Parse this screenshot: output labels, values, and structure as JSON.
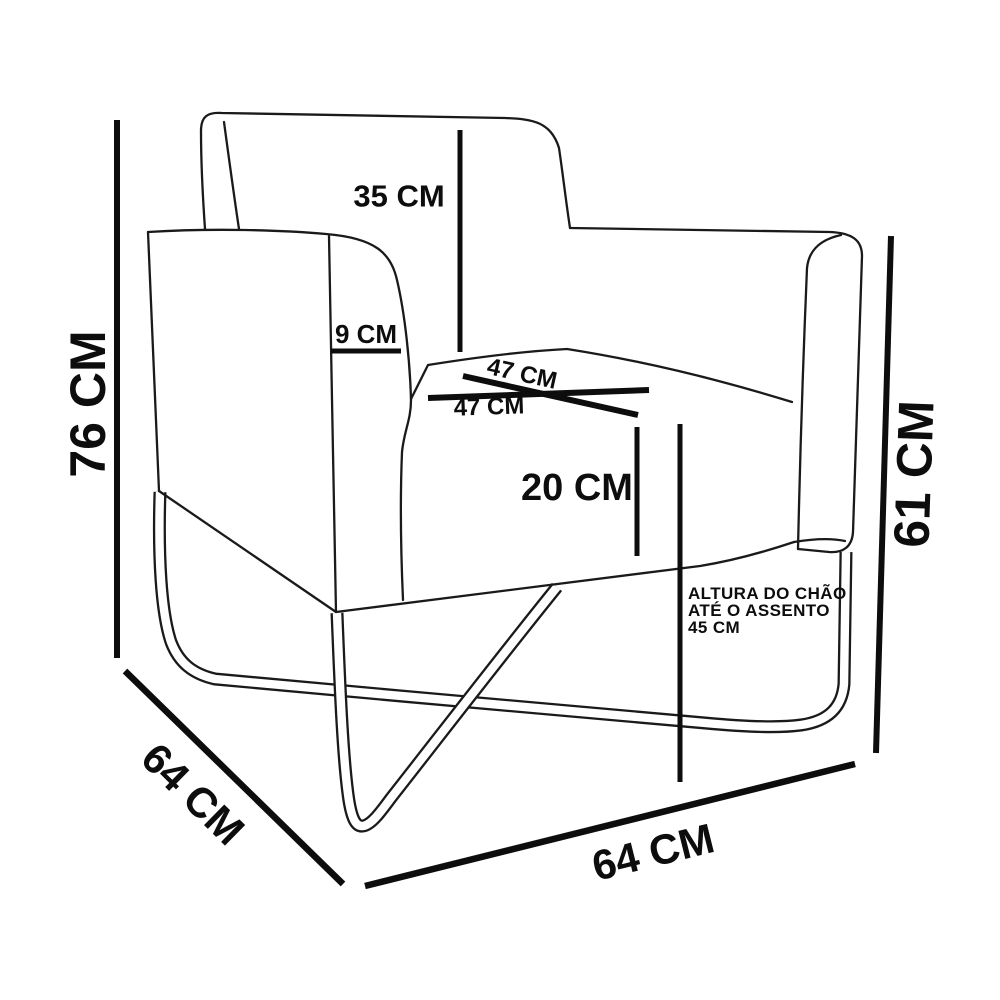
{
  "diagram": {
    "title": "armchair dimensions diagram",
    "background": "#ffffff",
    "chair_stroke_color": "#1a1a1a",
    "annotation_color": "#0d0d0d"
  },
  "dimensions": {
    "total_height": "76 CM",
    "backrest_height": "35 CM",
    "armrest_thickness": "9 CM",
    "seat_width": "47 CM",
    "seat_depth": "47 CM",
    "seat_cushion_front_height": "20 CM",
    "arm_height": "61 CM",
    "side_depth": "64 CM",
    "front_width": "64 CM"
  },
  "floor_to_seat_note": {
    "line1": "ALTURA DO CHÃO",
    "line2": "ATÉ O ASSENTO",
    "line3": "45 CM"
  }
}
